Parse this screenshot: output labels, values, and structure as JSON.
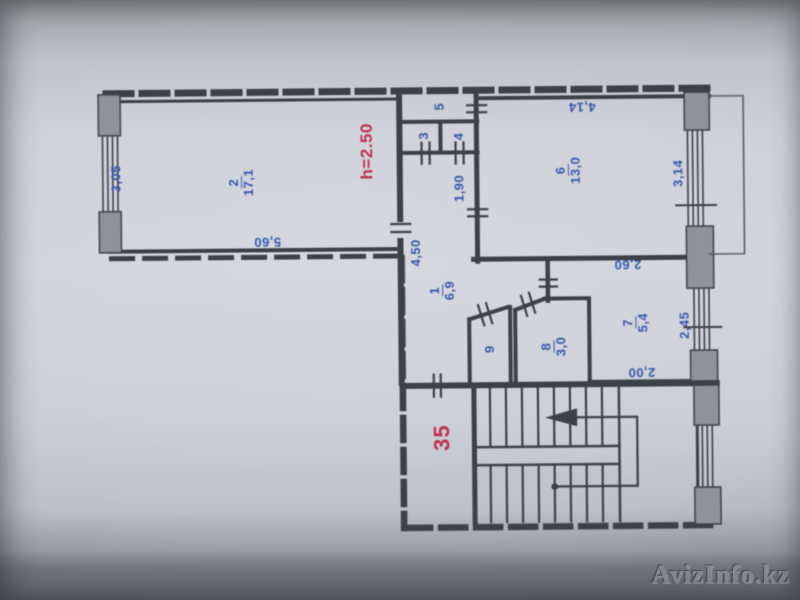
{
  "plan": {
    "rooms": {
      "room1": {
        "number": "1",
        "area": "6,9"
      },
      "room2": {
        "number": "2",
        "area": "17,1"
      },
      "room3": {
        "number": "3"
      },
      "room4": {
        "number": "4"
      },
      "room5": {
        "number": "5"
      },
      "room6": {
        "number": "6",
        "area": "13,0"
      },
      "room7": {
        "number": "7",
        "area": "5,4"
      },
      "room8": {
        "number": "8",
        "area": "3,0"
      },
      "room9": {
        "number": "9"
      }
    },
    "dimensions": {
      "room2_side": "3,05",
      "room2_bottom": "5,60",
      "hall_side": "4,50",
      "corridor": "1,90",
      "room6_top": "4,14",
      "room6_side": "3,14",
      "room7_top": "2,60",
      "room7_side": "2,45",
      "room7_bottom": "2,00"
    },
    "annotations": {
      "ceiling_height": "h=2.50",
      "unit_number": "35"
    }
  },
  "watermark": {
    "text": "AvizInfo.kz"
  },
  "colors": {
    "ink": "#3a3e45",
    "blue": "#3557ae",
    "red": "#c22e4e",
    "paper": "#cdd0d8",
    "pier": "#8f939b"
  }
}
